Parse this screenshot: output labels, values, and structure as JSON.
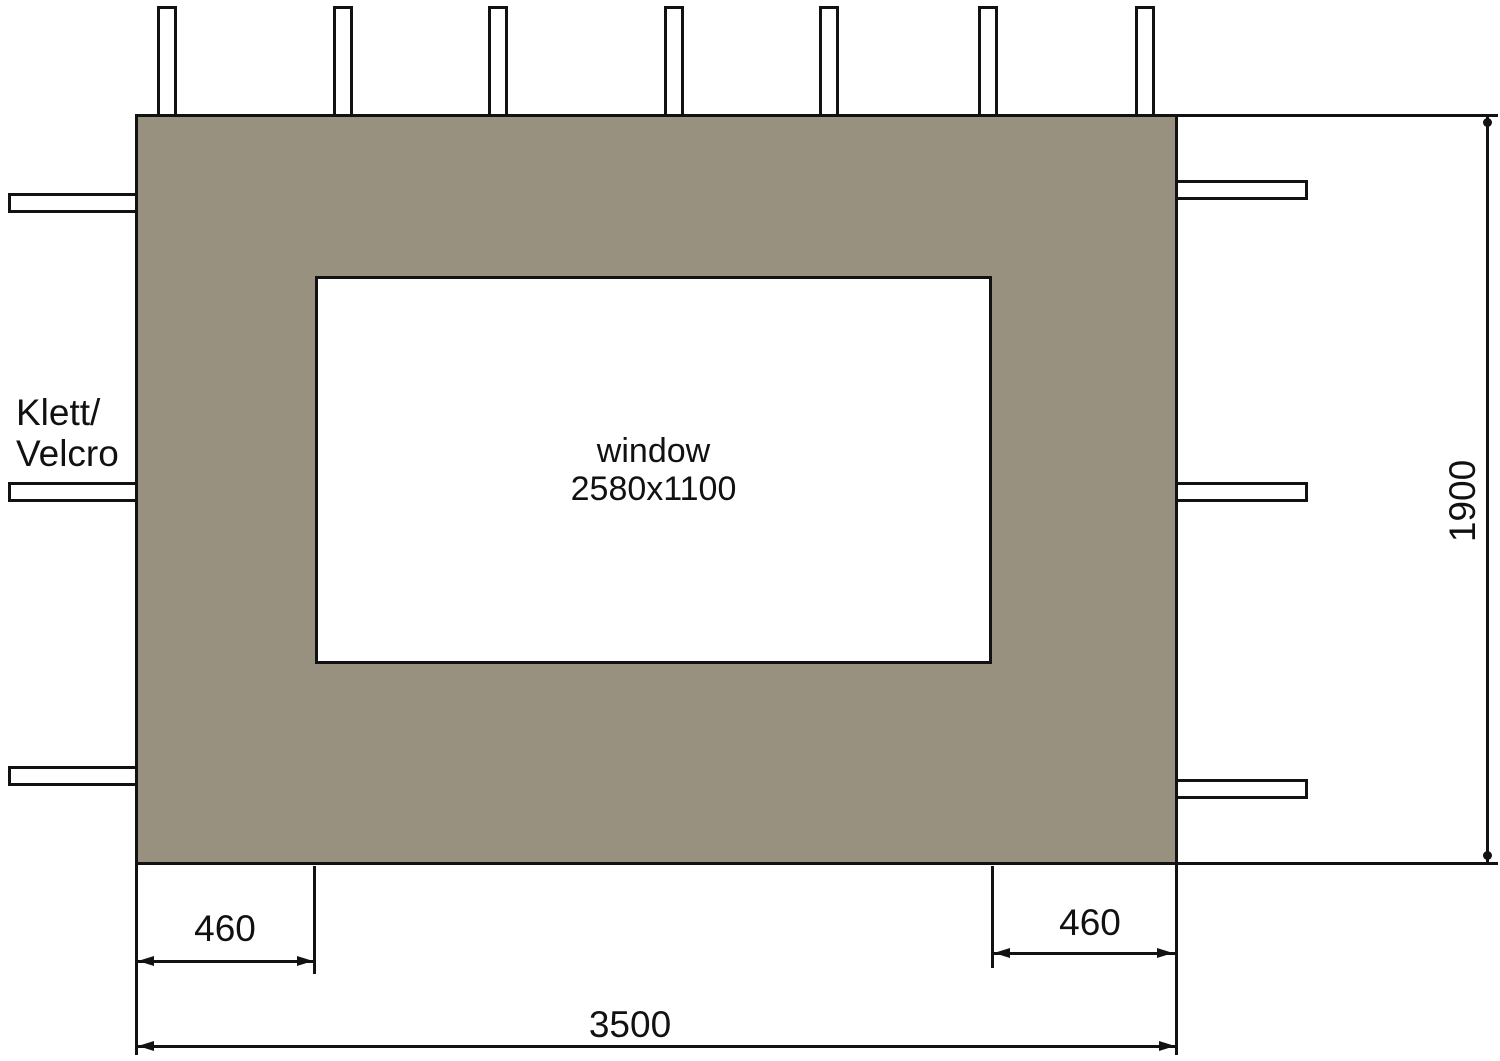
{
  "labels": {
    "attachment_line1": "Klett/",
    "attachment_line2": "Velcro",
    "window_name": "window",
    "window_size": "2580x1100"
  },
  "dimensions": {
    "total_width_mm": "3500",
    "total_height_mm": "1900",
    "left_offset_mm": "460",
    "right_offset_mm": "460"
  },
  "colors": {
    "panel_fill": "#999180",
    "line": "#121212",
    "background": "#ffffff",
    "strap_fill": "#ffffff"
  }
}
